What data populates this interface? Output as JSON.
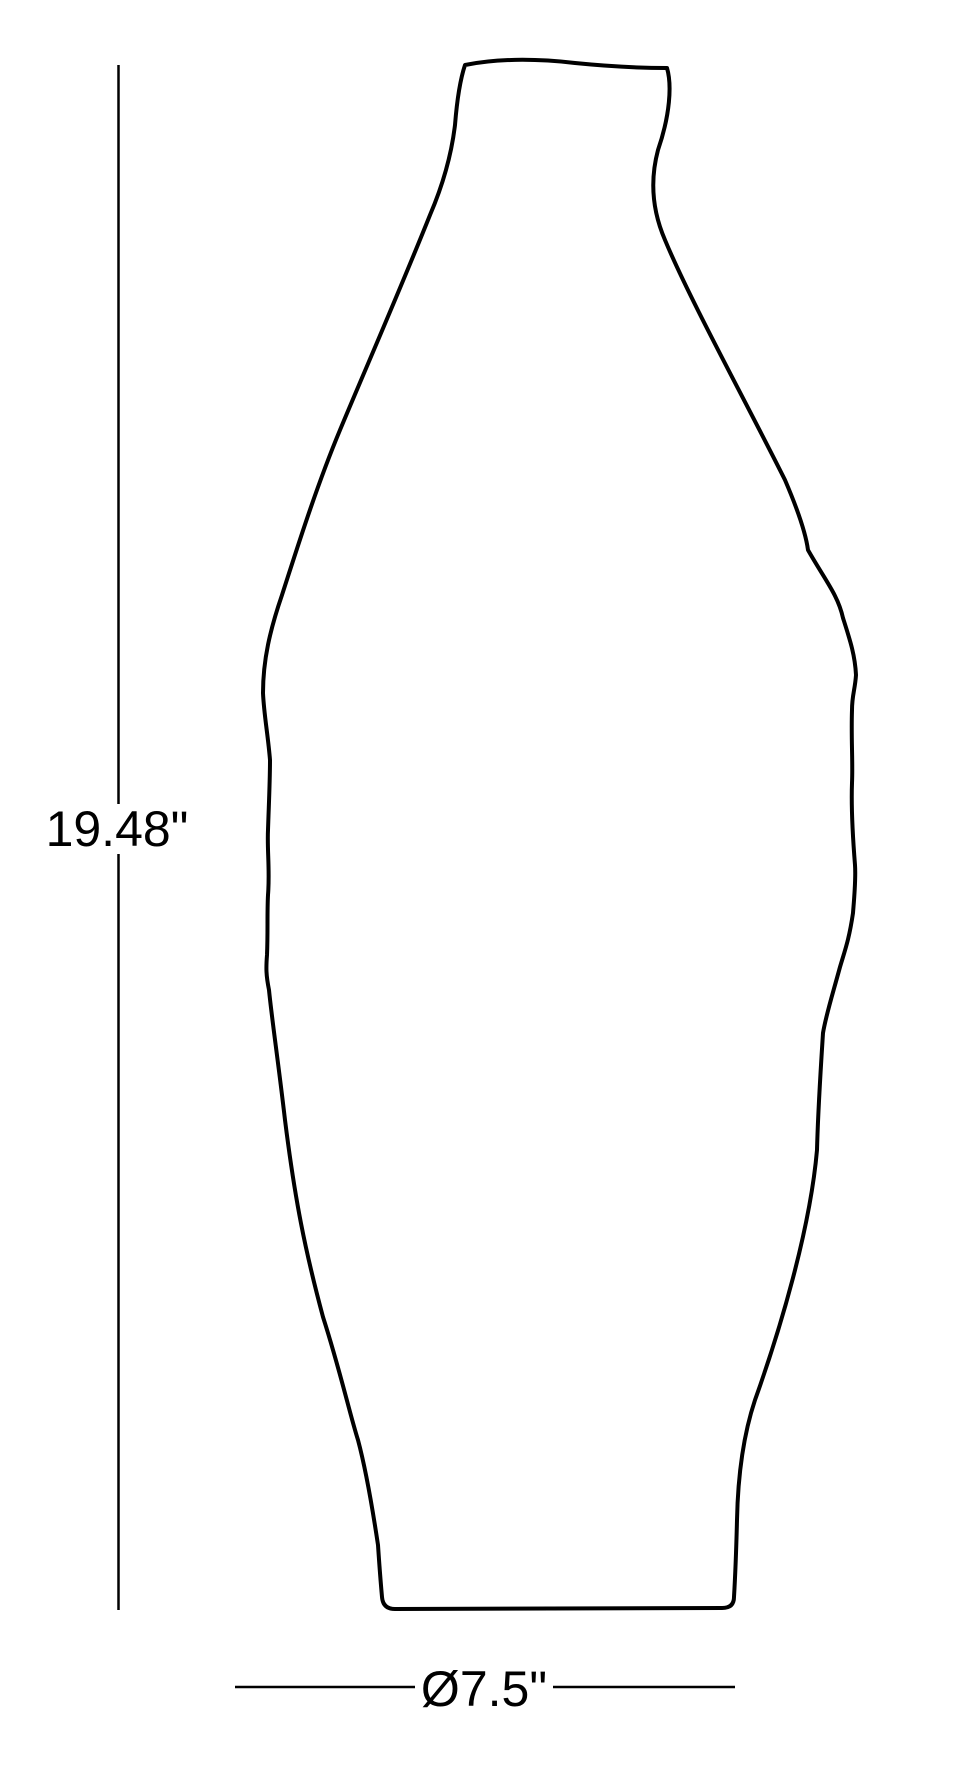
{
  "drawing": {
    "object": "vase-outline-dimension-drawing",
    "height_label": "19.48\"",
    "diameter_label": "Ø7.5\"",
    "line_color": "#000000",
    "background_color": "#ffffff"
  }
}
